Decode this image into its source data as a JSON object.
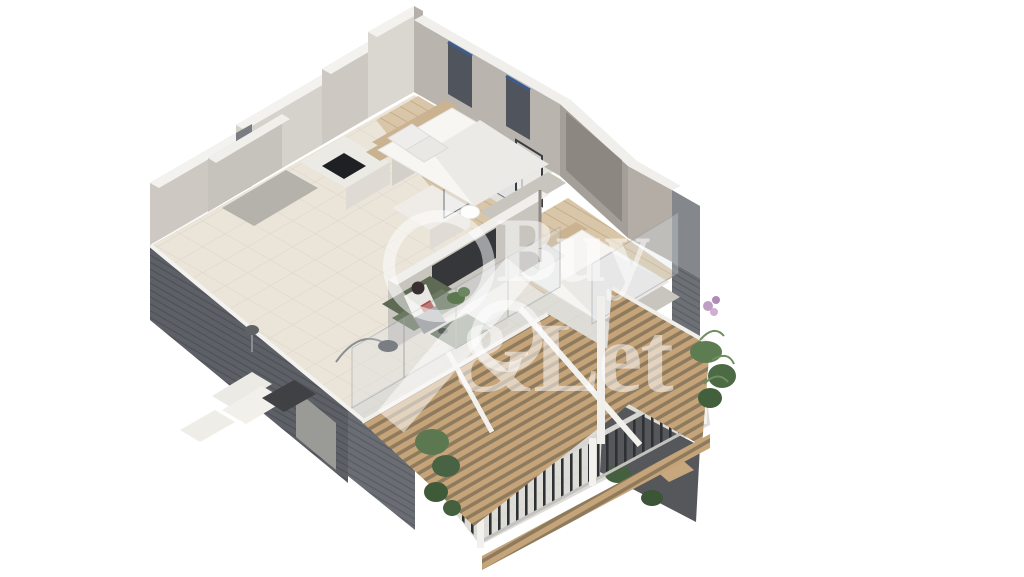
{
  "watermark": {
    "line1": "Buy",
    "line2": "&Let",
    "emblem": "percent-ring-mark"
  },
  "scene": {
    "type": "isometric-3d-floor-plan-render",
    "elements": [
      "kitchen",
      "living-room",
      "bedroom-1",
      "bedroom-2",
      "bathroom-shower",
      "hallway",
      "terrace",
      "wood-pergola",
      "metal-railing",
      "plants",
      "seated-person",
      "tv-unit",
      "beds"
    ]
  },
  "colors": {
    "bg": "#ffffff",
    "wall-dark": "#5d6167",
    "wall-dark-shade": "#4d5158",
    "wall-light": "#cdc9c2",
    "wall-lighter": "#dad7d1",
    "wall-shadow": "#a9a39c",
    "wall-cap": "#f3f2ef",
    "floor-tile": "#eae4d9",
    "floor-wood": "#d9c6a8",
    "bath-tile": "#e3e1dc",
    "terrace-tile": "#dedcd6",
    "pergola-wood": "#c6a47a",
    "railing-dark": "#2e3134",
    "rail-light": "#d7d6d2",
    "glass": "#dfe3e6",
    "sofa-green": "#6d7860",
    "plant-green": "#5c7851",
    "plant-dark": "#44603e",
    "flower-pink": "#c09ec4",
    "bed-white": "#f7f6f3",
    "headboard-tan": "#cbb391",
    "accent-blue": "#3c5c8e",
    "tv-dark": "#35373a",
    "watermark": "rgba(255,255,255,0.52)"
  }
}
